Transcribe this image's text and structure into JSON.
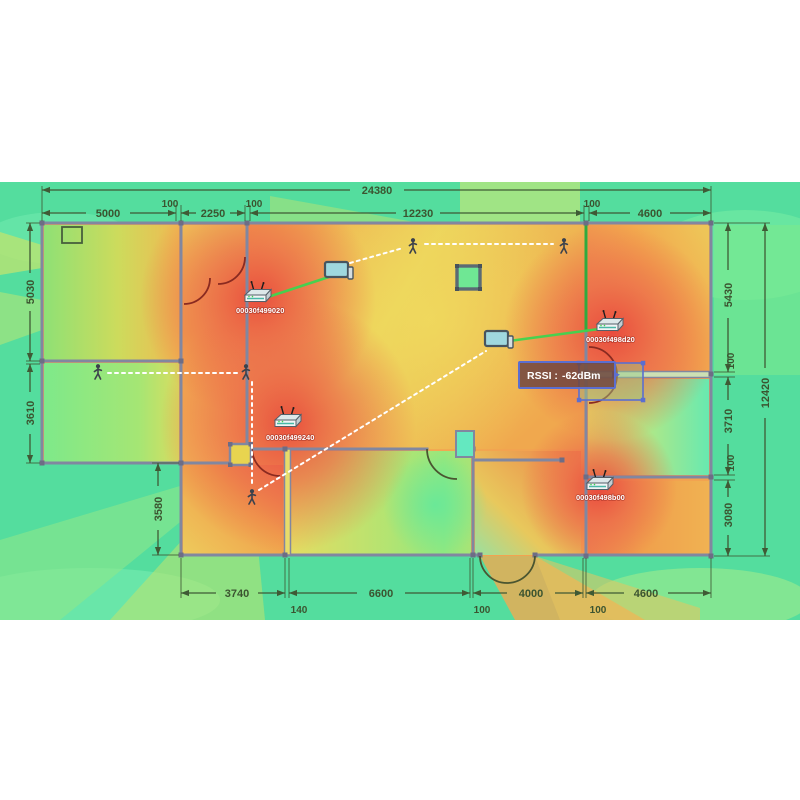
{
  "app": {
    "description": "Wireless coverage heatmap over building floor plan",
    "colors": {
      "heat_strong": "#ee5a48",
      "heat_medium": "#f2a84e",
      "heat_weak": "#e8dc62",
      "heat_low": "#8ee87c",
      "heat_minimal": "#54dd9e",
      "link_green": "#3fd44f",
      "selection_blue": "#5b6ed0",
      "dimension_color": "#3b5430",
      "wall_color": "#8187a0",
      "walk_path_white": "#ffffff"
    }
  },
  "dimensions": {
    "top_total": "24380",
    "top": [
      "5000",
      "100",
      "2250",
      "100",
      "12230",
      "100",
      "4600"
    ],
    "bottom": [
      "3740",
      "140",
      "6600",
      "100",
      "4000",
      "100",
      "4600"
    ],
    "left": [
      "5030",
      "3610",
      "3580"
    ],
    "right": [
      "5430",
      "100",
      "3710",
      "100",
      "3080"
    ],
    "right_total": "12420"
  },
  "access_points": [
    {
      "label": "00030f499020"
    },
    {
      "label": "00030f498d20"
    },
    {
      "label": "00030f499240"
    },
    {
      "label": "00030f498b00"
    }
  ],
  "rssi_tooltip": {
    "label": "RSSI :",
    "value": "-62dBm"
  },
  "icons": {
    "person": "walking-person",
    "laptop": "laptop-client",
    "access_point": "wireless-router",
    "desk": "table-furniture",
    "window": "window",
    "column": "structural-column"
  }
}
